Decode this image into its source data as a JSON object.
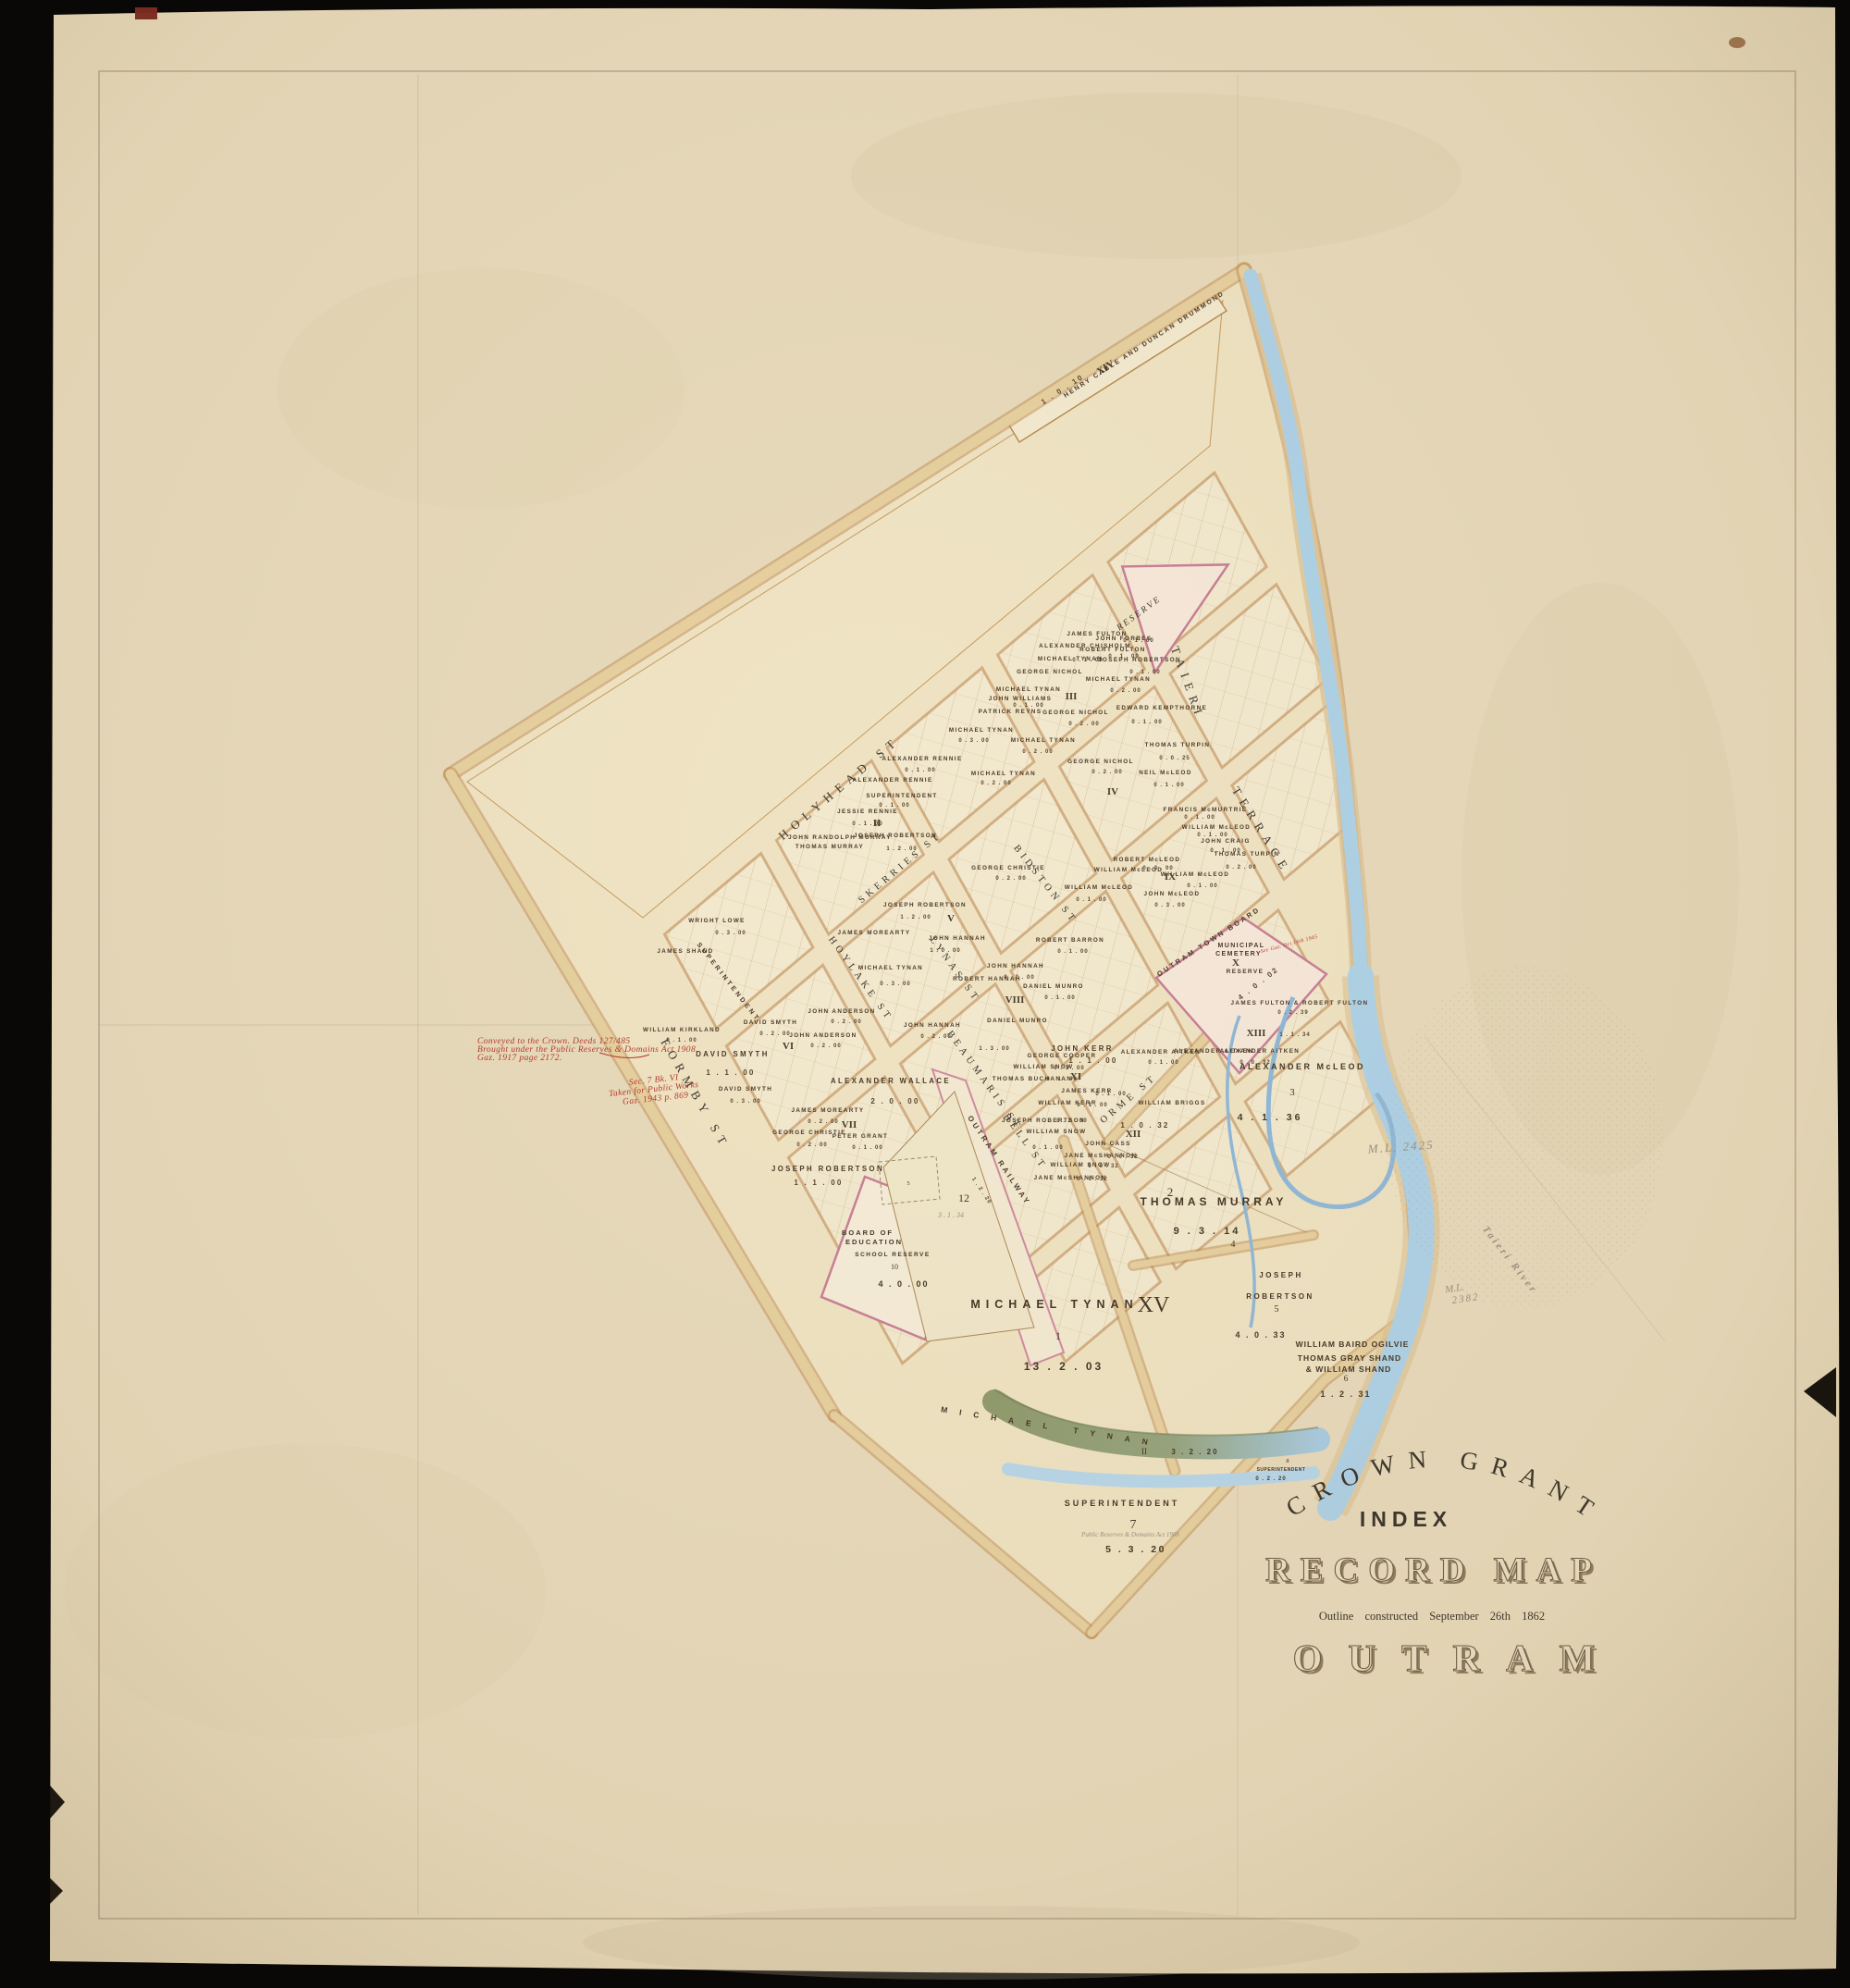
{
  "colors": {
    "background": "#0a0807",
    "paper": "#e7dabb",
    "road_tan": "#e7d0a0",
    "block_pale": "#f2e9cf",
    "reserve_pink": "#c87f96",
    "river_blue": "#aed2e8",
    "red_ink": "#b5382a",
    "pencil": "#9a9082"
  },
  "title": {
    "arc": "CROWN GRANT",
    "index": "INDEX",
    "record": "RECORD MAP",
    "outline": "Outline constructed September 26th 1862",
    "town": "OUTRAM"
  },
  "red_notes": {
    "l1": "Conveyed to the Crown. Deeds 127/485",
    "l2": "Brought under the Public Reserves & Domains Act 1908",
    "l3": "Gaz. 1917 page 2172.",
    "s1": "Sec. 7 Bk. VI",
    "s2": "Taken for Public Works",
    "s3": "Gaz. 1943 p. 869",
    "cem": "See Gaz. Oct 16th 1945"
  },
  "pencil": {
    "ml1": "M.L. 2425",
    "ml2a": "M.L.",
    "ml2b": "2382",
    "river": "Taieri River",
    "twelve_area": "3 . 1 . 34",
    "act": "Public Reserves & Domains Act 1908"
  },
  "streets": {
    "holyhead": "HOLYHEAD ST",
    "skerries": "SKERRIES ST",
    "bidston": "BIDSTON ST",
    "hoylake": "HOYLAKE ST",
    "lynas": "LYNAS ST",
    "formby": "FORMBY ST",
    "beaumaris": "BEAUMARIS ST",
    "bell": "BELL ST",
    "orme": "ORME ST",
    "taieri": "TAIERI",
    "terrace": "TERRACE",
    "superintendent_strip": "SUPERINTENDENT",
    "railway": "OUTRAM RAILWAY",
    "railway_area": "1 . 2 . 20"
  },
  "numerals": {
    "ii": "II",
    "iii": "III",
    "iv": "IV",
    "v": "V",
    "vi": "VI",
    "vii": "VII",
    "viii": "VIII",
    "ix": "IX",
    "xi": "XI",
    "xii": "XII",
    "xiii": "XIII",
    "xiii_area": "1 . 1 . 34"
  },
  "reserve_triangle": "RESERVE",
  "strip14": {
    "names": "HENRY CABLE AND DUNCAN DRUMMOND",
    "num": "XIV",
    "area": "1 . 0 . 10"
  },
  "cemetery": {
    "board": "OUTRAM TOWN BOARD",
    "l1": "MUNICIPAL",
    "l2": "CEMETERY",
    "num": "X",
    "l3": "RESERVE",
    "area": "4 . 0 . 02"
  },
  "sections": {
    "s1": {
      "name": "MICHAEL TYNAN",
      "num": "1",
      "area": "13 . 2 . 03"
    },
    "s2": {
      "num": "2",
      "name": "THOMAS MURRAY",
      "area": "9 . 3 . 14",
      "sub": "4"
    },
    "s3": {
      "name": "ALEXANDER McLEOD",
      "num": "3",
      "area": "4 . 1 . 36"
    },
    "s5": {
      "l1": "JOSEPH",
      "l2": "ROBERTSON",
      "num": "5",
      "area": "4 . 0 . 33"
    },
    "s6": {
      "l1": "WILLIAM BAIRD OGILVIE",
      "l2": "THOMAS GRAY SHAND",
      "l3": "& WILLIAM SHAND",
      "num": "6",
      "area": "1 . 2 . 31"
    },
    "s7": {
      "name": "SUPERINTENDENT",
      "num": "7",
      "area": "5 . 3 . 20"
    },
    "s8": {
      "num": "8",
      "name": "SUPERINTENDENT",
      "area": "0 . 2 . 20"
    },
    "s10": {
      "l1": "BOARD OF",
      "l2": "EDUCATION",
      "l3": "SCHOOL RESERVE",
      "num": "10",
      "area": "4 . 0 . 00"
    },
    "s12": {
      "num": "12",
      "lot": "5"
    },
    "creek": {
      "name": "MICHAEL TYNAN",
      "num": "II",
      "area": "3 . 2 . 20"
    },
    "xv": "XV"
  },
  "parcels": [
    "GEORGE NICHOL",
    "MICHAEL TYNAN",
    "JOHN WILLIAMS",
    "PATRICK REYNS",
    "0 . 1 . 00",
    "MICHAEL TYNAN",
    "0 . 3 . 00",
    "MICHAEL TYNAN",
    "0 . 2 . 00",
    "MICHAEL TYNAN",
    "0 . 2 . 00",
    "ALEXANDER RENNIE",
    "0 . 1 . 00",
    "ALEXANDER RENNIE",
    "SUPERINTENDENT",
    "0 . 1 . 00",
    "JESSIE RENNIE",
    "0 . 1 . 00",
    "JOSEPH ROBERTSON",
    "1 . 2 . 00",
    "JOHN RANDOLPH MURRAY",
    "THOMAS MURRAY",
    "GEORGE NICHOL",
    "0 . 2 . 00",
    "MICHAEL TYNAN",
    "0 . 2 . 00",
    "MICHAEL TYNAN",
    "0 . 1 . 00",
    "JAMES FULTON",
    "ALEXANDER CHISHOLM",
    "JOHN FORBES",
    "0 . 1 . 00",
    "ROBERT FULTON",
    "0 . 1 . 00",
    "JOSEPH ROBERTSON",
    "0 . 1 . 00",
    "GEORGE NICHOL",
    "0 . 2 . 00",
    "NEIL McLEOD",
    "0 . 1 . 00",
    "THOMAS TURPIN",
    "0 . 0 . 25",
    "EDWARD KEMPTHORNE",
    "0 . 1 . 00",
    "JOSEPH ROBERTSON",
    "1 . 2 . 00",
    "JOHN HANNAH",
    "1 . 0 . 00",
    "MICHAEL TYNAN",
    "0 . 3 . 00",
    "JAMES MOREARTY",
    "GEORGE CHRISTIE",
    "0 . 2 . 00",
    "WRIGHT LOWE",
    "0 . 3 . 00",
    "JAMES SHAND",
    "WILLIAM KIRKLAND",
    "0 . 1 . 00",
    "DAVID SMYTH",
    "1 . 1 . 00",
    "DAVID SMYTH",
    "0 . 2 . 00",
    "DAVID SMYTH",
    "0 . 3 . 00",
    "JOHN ANDERSON",
    "0 . 2 . 00",
    "JOHN ANDERSON",
    "0 . 2 . 00",
    "ALEXANDER WALLACE",
    "2 . 0 . 00",
    "JAMES MOREARTY",
    "0 . 2 . 00",
    "GEORGE CHRISTIE",
    "0 . 2 . 00",
    "PETER GRANT",
    "0 . 1 . 00",
    "JOSEPH ROBERTSON",
    "1 . 1 . 00",
    "JOHN HANNAH",
    "0 . 2 . 00",
    "ROBERT HANNAH",
    "DANIEL MUNRO",
    "1 . 3 . 00",
    "ROBERT BARRON",
    "0 . 1 . 00",
    "DANIEL MUNRO",
    "0 . 1 . 00",
    "JOHN HANNAH",
    "0 . 2 . 00",
    "ROBERT McLEOD",
    "0 . 3 . 00",
    "WILLIAM McLEOD",
    "WILLIAM McLEOD",
    "0 . 1 . 00",
    "JOHN McLEOD",
    "0 . 3 . 00",
    "WILLIAM McLEOD",
    "0 . 1 . 00",
    "THOMAS TURPIN",
    "0 . 2 . 00",
    "JOHN CRAIG",
    "0 . 1 . 00",
    "FRANCIS McMURTRIE",
    "0 . 1 . 00",
    "WILLIAM McLEOD",
    "0 . 1 . 00",
    "JOHN KERR",
    "1 . 1 . 00",
    "GEORGE COOPER",
    "WILLIAM SNOW",
    "0 . 1 . 00",
    "THOMAS BUCHANAN",
    "0 . 1 . 00",
    "JAMES KERR",
    "0 . 1 . 00",
    "WILLIAM KERR",
    "0 . 1 . 00",
    "JOSEPH ROBERTSON",
    "0 . 2 . 00",
    "WILLIAM SNOW",
    "0 . 1 . 00",
    "WILLIAM BRIGGS",
    "1 . 0 . 32",
    "JOHN CASS",
    "JANE McSHANNON",
    "0 . 0 . 32",
    "WILLIAM SNOW",
    "0 . 0 . 32",
    "JANE McSHANNON",
    "0 . 0 . 32",
    "ALEXANDER AITKEN",
    "0 . 1 . 00",
    "ALEXANDER AITKEN",
    "ALEXANDER AITKEN",
    "0 . 0 . 32",
    "JAMES FULTON & ROBERT FULTON",
    "0 . 2 . 39"
  ]
}
